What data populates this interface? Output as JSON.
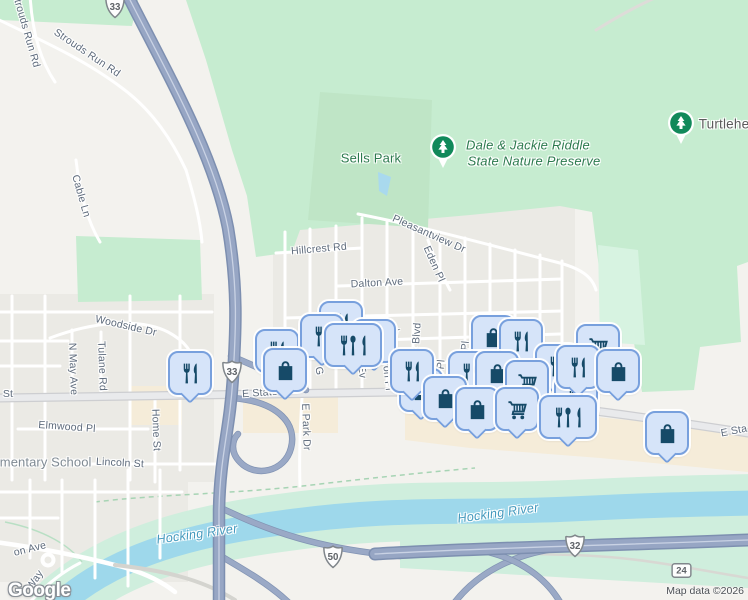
{
  "google_logo": "Google",
  "attribution": "Map data ©2026",
  "colors": {
    "marker_fill": "#d6e4f9",
    "marker_border": "#78a0dd",
    "marker_icon": "#164a68",
    "park_green": "#c6ecd0",
    "water_blue": "#9ed8eb",
    "tree_pin_green": "#11895a",
    "commercial_beige": "#f5ecd9",
    "highway_fill": "#97a6c4"
  },
  "labels": [
    {
      "text": "Strouds Run Rd",
      "x": 26,
      "y": 30,
      "rot": 74,
      "cls": "street"
    },
    {
      "text": "Strouds Run Rd",
      "x": 87,
      "y": 53,
      "rot": 34,
      "cls": "street"
    },
    {
      "text": "Cable Ln",
      "x": 81,
      "y": 196,
      "rot": 74,
      "cls": "street"
    },
    {
      "text": "Woodside Dr",
      "x": 126,
      "y": 326,
      "rot": 13,
      "cls": "street"
    },
    {
      "text": "N May Ave",
      "x": 73,
      "y": 369,
      "rot": 88,
      "cls": "street"
    },
    {
      "text": "Tulane Rd",
      "x": 102,
      "y": 366,
      "rot": 88,
      "cls": "street"
    },
    {
      "text": "Home St",
      "x": 156,
      "y": 430,
      "rot": 88,
      "cls": "street"
    },
    {
      "text": "Elmwood Pl",
      "x": 67,
      "y": 427,
      "rot": 4,
      "cls": "street"
    },
    {
      "text": "Lincoln St",
      "x": 120,
      "y": 463,
      "rot": 3,
      "cls": "street"
    },
    {
      "text": "ementary School",
      "x": 42,
      "y": 462,
      "rot": 0,
      "cls": "school"
    },
    {
      "text": "St",
      "x": 8,
      "y": 394,
      "rot": 0,
      "cls": "street"
    },
    {
      "text": "E State",
      "x": 260,
      "y": 393,
      "rot": -4,
      "cls": "street"
    },
    {
      "text": "E Sta",
      "x": 734,
      "y": 431,
      "rot": -11,
      "cls": "street"
    },
    {
      "text": "Hillcrest Rd",
      "x": 319,
      "y": 249,
      "rot": -5,
      "cls": "street"
    },
    {
      "text": "Dalton Ave",
      "x": 377,
      "y": 283,
      "rot": -3,
      "cls": "street"
    },
    {
      "text": "Pleasantview Dr",
      "x": 429,
      "y": 234,
      "rot": 24,
      "cls": "street"
    },
    {
      "text": "Eden Pl",
      "x": 434,
      "y": 264,
      "rot": 66,
      "cls": "street"
    },
    {
      "text": "Park Blvd",
      "x": 416,
      "y": 346,
      "rot": -86,
      "cls": "street"
    },
    {
      "text": "Avon Pl",
      "x": 387,
      "y": 372,
      "rot": 84,
      "cls": "street"
    },
    {
      "text": "Ev",
      "x": 362,
      "y": 372,
      "rot": 84,
      "cls": "street"
    },
    {
      "text": "G",
      "x": 319,
      "y": 371,
      "rot": 80,
      "cls": "street"
    },
    {
      "text": "E Park Dr",
      "x": 306,
      "y": 427,
      "rot": 88,
      "cls": "street"
    },
    {
      "text": "den Pl",
      "x": 440,
      "y": 375,
      "rot": -84,
      "cls": "street"
    },
    {
      "text": "send Pl",
      "x": 464,
      "y": 359,
      "rot": -84,
      "cls": "street"
    },
    {
      "text": "Dr",
      "x": 394,
      "y": 331,
      "rot": 8,
      "cls": "street"
    },
    {
      "text": "on Ave",
      "x": 30,
      "y": 549,
      "rot": -14,
      "cls": "street"
    },
    {
      "text": "Way",
      "x": 35,
      "y": 580,
      "rot": -55,
      "cls": "street"
    },
    {
      "text": "Hocking River",
      "x": 197,
      "y": 534,
      "rot": -8,
      "cls": "water"
    },
    {
      "text": "Hocking River",
      "x": 498,
      "y": 513,
      "rot": -8,
      "cls": "water"
    },
    {
      "text": "Sells Park",
      "x": 371,
      "y": 158,
      "rot": 0,
      "cls": "park"
    },
    {
      "text": "Dale & Jackie Riddle",
      "x": 528,
      "y": 145,
      "rot": 0,
      "cls": "preserve"
    },
    {
      "text": "State Nature Preserve",
      "x": 534,
      "y": 161,
      "rot": 0,
      "cls": "preserve"
    },
    {
      "text": "Turtlehe",
      "x": 724,
      "y": 124,
      "rot": 0,
      "cls": "poi"
    }
  ],
  "markers": [
    {
      "x": 277,
      "y": 351,
      "type": "restaurant"
    },
    {
      "x": 341,
      "y": 323,
      "type": "restaurant"
    },
    {
      "x": 374,
      "y": 341,
      "type": "restaurant"
    },
    {
      "x": 493,
      "y": 337,
      "type": "shopping-bag"
    },
    {
      "x": 521,
      "y": 341,
      "type": "restaurant"
    },
    {
      "x": 557,
      "y": 366,
      "type": "restaurant"
    },
    {
      "x": 576,
      "y": 397,
      "type": "restaurant"
    },
    {
      "x": 421,
      "y": 390,
      "type": "shopping-bag"
    },
    {
      "x": 322,
      "y": 336,
      "type": "restaurant"
    },
    {
      "x": 353,
      "y": 345,
      "type": "restaurant-wide"
    },
    {
      "x": 598,
      "y": 346,
      "type": "shopping-cart"
    },
    {
      "x": 470,
      "y": 373,
      "type": "restaurant"
    },
    {
      "x": 497,
      "y": 373,
      "type": "shopping-bag"
    },
    {
      "x": 527,
      "y": 382,
      "type": "shopping-cart"
    },
    {
      "x": 578,
      "y": 367,
      "type": "restaurant"
    },
    {
      "x": 618,
      "y": 371,
      "type": "shopping-bag"
    },
    {
      "x": 190,
      "y": 373,
      "type": "restaurant"
    },
    {
      "x": 285,
      "y": 370,
      "type": "shopping-bag"
    },
    {
      "x": 412,
      "y": 371,
      "type": "restaurant"
    },
    {
      "x": 445,
      "y": 398,
      "type": "shopping-bag"
    },
    {
      "x": 477,
      "y": 409,
      "type": "shopping-bag"
    },
    {
      "x": 517,
      "y": 409,
      "type": "shopping-cart"
    },
    {
      "x": 568,
      "y": 417,
      "type": "restaurant-wide"
    },
    {
      "x": 667,
      "y": 433,
      "type": "shopping-bag"
    }
  ],
  "shields": [
    {
      "num": "33",
      "x": 115,
      "y": 8,
      "shape": "us"
    },
    {
      "num": "33",
      "x": 232,
      "y": 373,
      "shape": "us"
    },
    {
      "num": "50",
      "x": 333,
      "y": 558,
      "shape": "us"
    },
    {
      "num": "32",
      "x": 575,
      "y": 547,
      "shape": "us"
    },
    {
      "num": "24",
      "x": 681,
      "y": 570,
      "shape": "rect"
    }
  ],
  "tree_pins": [
    {
      "x": 443,
      "y": 147,
      "name": "nature-preserve-pin"
    },
    {
      "x": 681,
      "y": 123,
      "name": "turtlehead-pin"
    }
  ]
}
